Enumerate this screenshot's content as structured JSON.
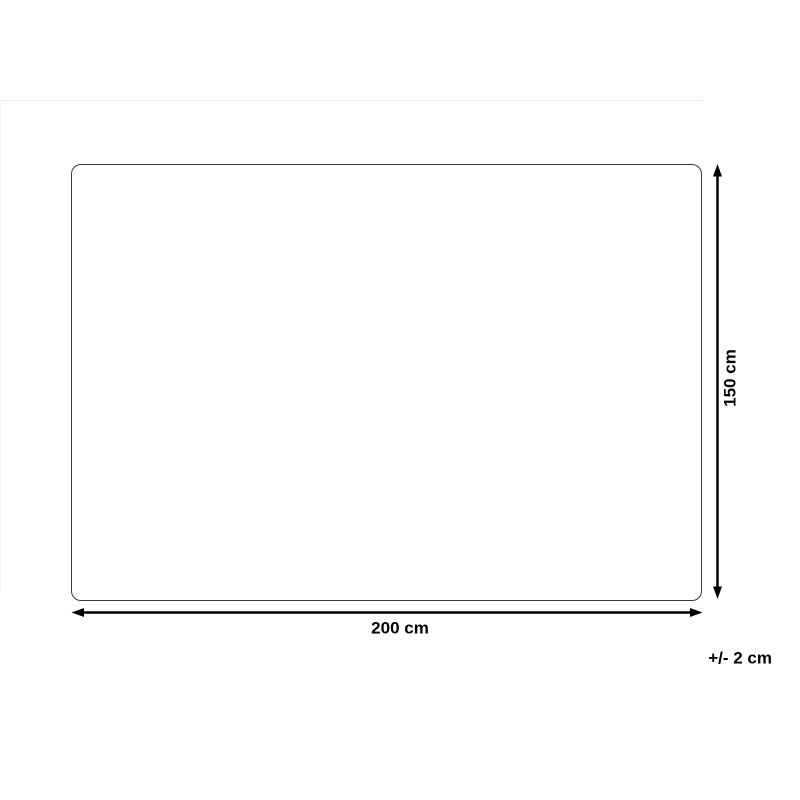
{
  "diagram": {
    "width_label": "200 cm",
    "height_label": "150 cm",
    "tolerance_label": "+/- 2 cm",
    "colors": {
      "background": "#ffffff",
      "outline": "#3a3a3a",
      "arrow": "#000000",
      "text": "#000000",
      "divider": "#eeeeee",
      "divider-light": "#f3f3f3"
    }
  }
}
